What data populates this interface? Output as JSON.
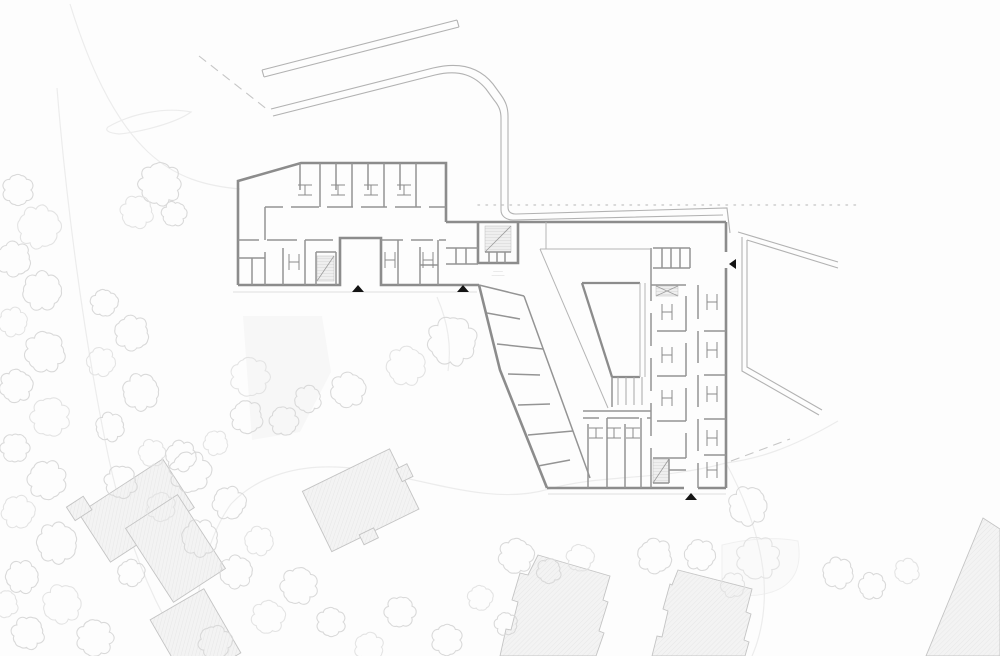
{
  "drawing": {
    "kind": "architectural-floor-site-plan",
    "annotations": {
      "stair_note_line1": "———",
      "stair_note_line2": "————"
    },
    "markers": {
      "west_wing_entrance": "▲",
      "central_entrance": "▲",
      "south_entrance": "▲",
      "east_entrance": "◀"
    }
  },
  "colors": {
    "paper": "#fdfdfd",
    "wall": "#8c8c8c",
    "partition": "#949494",
    "thinline": "#b5b5b5",
    "tree": "#d9d9d9",
    "road": "#ececec",
    "houseFill": "#f3f3f3",
    "houseStroke": "#c4c4c4",
    "marker": "#141414"
  }
}
